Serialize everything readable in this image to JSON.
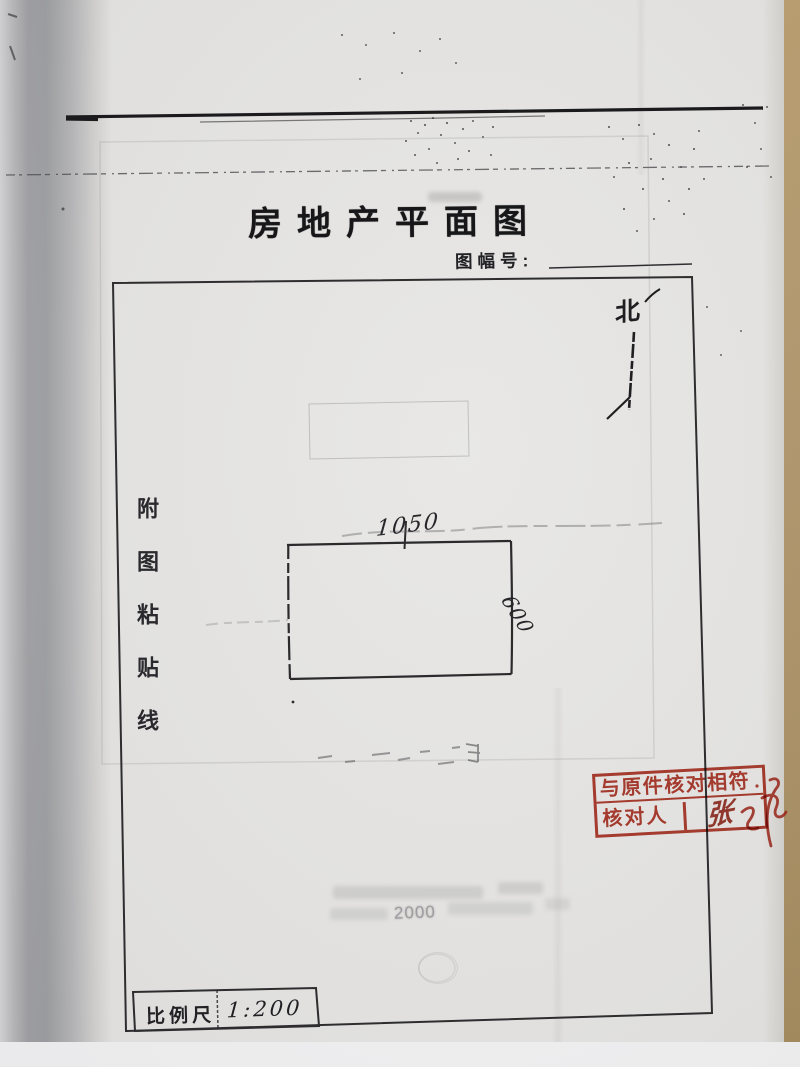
{
  "document": {
    "title": "房地产平面图",
    "sheet_no_label": "图幅号:",
    "sheet_no_value": "",
    "paste_line_text": "附图粘贴线",
    "north_label": "北",
    "scale_label": "比例尺",
    "scale_value": "1:200",
    "ghost_text": "2000"
  },
  "plot": {
    "width_label": "1050",
    "height_label": "600"
  },
  "stamp": {
    "line1": "与原件核对相符",
    "verifier_label": "核对人",
    "signature": "张"
  },
  "colors": {
    "stamp_red": "#b43829",
    "ink": "#1b1b1d",
    "paper": "#e6e5e3",
    "desk": "#b1966a"
  }
}
